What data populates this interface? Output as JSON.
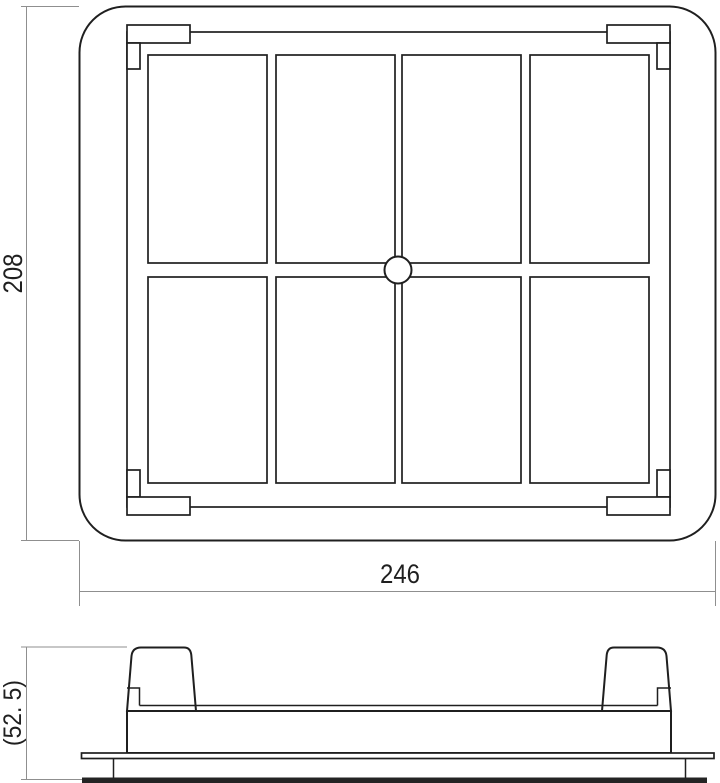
{
  "drawing": {
    "kind": "panel-air-filter-dimension-drawing",
    "views": {
      "top_view": "plan view with 4x2 grid and center boss",
      "side_view": "front elevation with two clips and flange"
    }
  },
  "dimensions": {
    "overall_height": "208",
    "overall_width": "246",
    "side_height": "(52. 5)"
  },
  "grid": {
    "rows": 2,
    "columns": 4,
    "center_circle": true
  },
  "colors": {
    "object_line": "#1f1f1f",
    "dimension_line": "#8f8f8f",
    "background": "#ffffff",
    "bottom_plate": "#242424",
    "text": "#1f1f1f"
  }
}
